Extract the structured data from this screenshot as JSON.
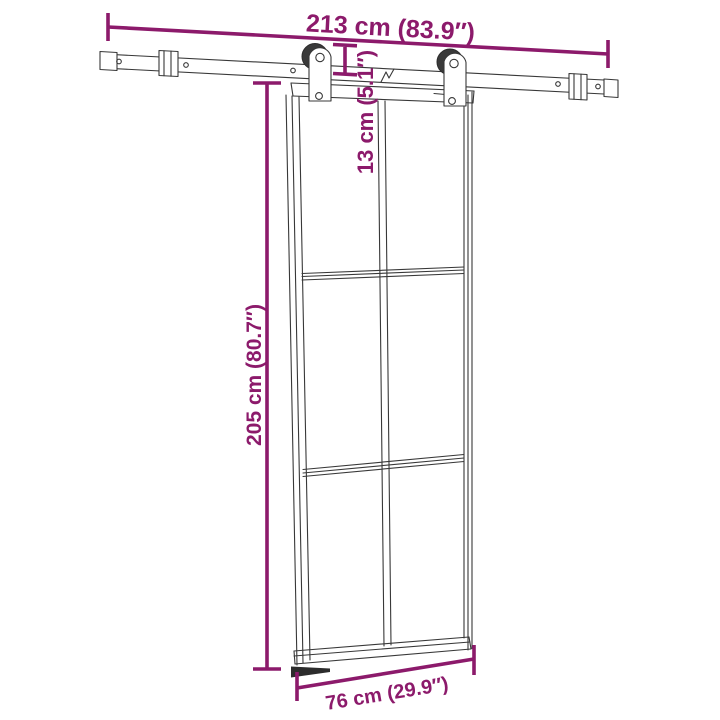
{
  "diagram": {
    "kind": "sliding-door-dimension-diagram",
    "colors": {
      "background": "#ffffff",
      "dimension_accent": "#8c1a6b",
      "line_art": "#383838"
    },
    "dimensions": {
      "rail_length": "213 cm (83.9″)",
      "rail_to_door_gap": "13 cm (5.1″)",
      "door_height": "205 cm (80.7″)",
      "door_width": "76 cm (29.9″)"
    }
  }
}
